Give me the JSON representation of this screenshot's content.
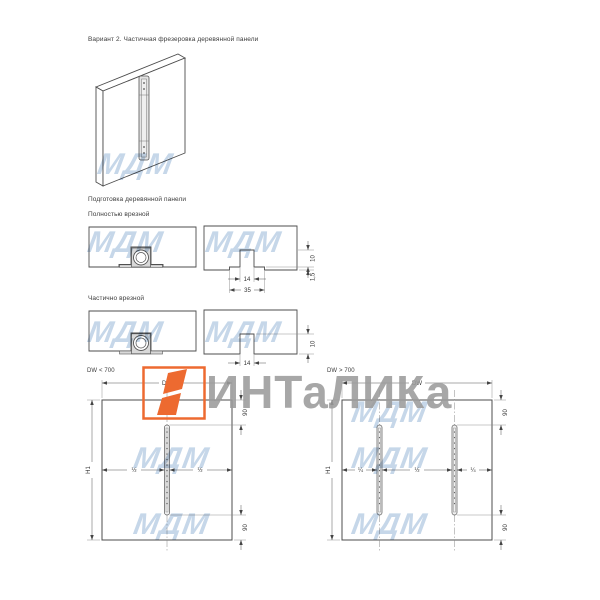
{
  "page": {
    "title": "Вариант 2. Частичная фрезеровка деревянной панели",
    "prep_heading": "Подготовка деревянной панели"
  },
  "sections": {
    "full_recess": {
      "label": "Полностью врезной",
      "dims": {
        "inner_width": "14",
        "outer_width": "35",
        "depth": "10",
        "step": "1,5"
      }
    },
    "partial_recess": {
      "label": "Частично врезной",
      "dims": {
        "inner_width": "14",
        "depth": "10"
      }
    }
  },
  "panels": {
    "narrow": {
      "label": "DW < 700",
      "width_dim": "DW",
      "height_dim": "H1",
      "top_offset": "90",
      "bottom_offset": "90",
      "left_frac": "½",
      "right_frac": "½"
    },
    "wide": {
      "label": "DW > 700",
      "width_dim": "DW",
      "height_dim": "H1",
      "top_offset": "90",
      "bottom_offset": "90",
      "frac_left": "¼",
      "frac_mid": "½",
      "frac_right": "¼"
    }
  },
  "watermark": {
    "brand": "ИНТаЛИКа",
    "tile": "МДМ",
    "accent_color": "#ed6a30",
    "brand_text_color": "#9b9b9b",
    "tile_color": "#c6d7e9"
  }
}
